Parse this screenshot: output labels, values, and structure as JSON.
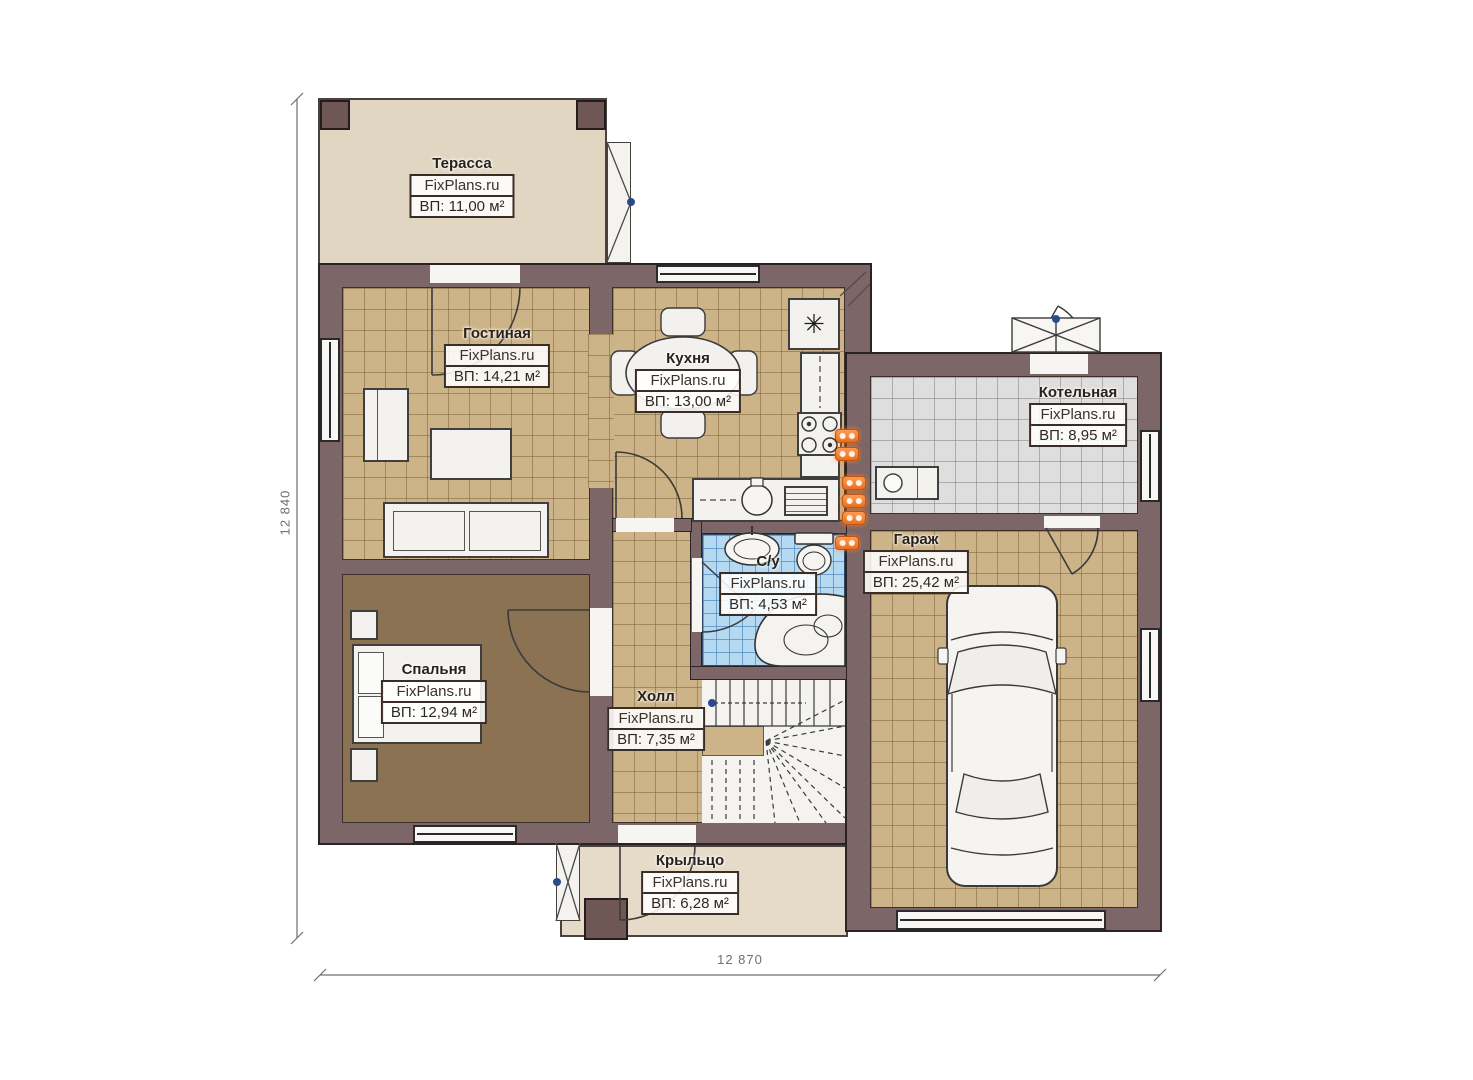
{
  "watermark": "FixPlans.ru",
  "rooms": {
    "terrace": {
      "name": "Терасса",
      "area": "ВП: 11,00 м²"
    },
    "living": {
      "name": "Гостиная",
      "area": "ВП: 14,21 м²"
    },
    "kitchen": {
      "name": "Кухня",
      "area": "ВП: 13,00 м²"
    },
    "boiler": {
      "name": "Котельная",
      "area": "ВП: 8,95 м²"
    },
    "garage": {
      "name": "Гараж",
      "area": "ВП: 25,42 м²"
    },
    "bathroom": {
      "name": "С/у",
      "area": "ВП: 4,53 м²"
    },
    "bedroom": {
      "name": "Спальня",
      "area": "ВП: 12,94 м²"
    },
    "hall": {
      "name": "Холл",
      "area": "ВП: 7,35 м²"
    },
    "porch": {
      "name": "Крыльцо",
      "area": "ВП: 6,28 м²"
    }
  },
  "dimensions": {
    "left": "12 840",
    "bottom": "12 870"
  },
  "symbols": {
    "freezer": "✳"
  },
  "colors": {
    "wall": "#7d6667",
    "floor_tan": "#cdb388",
    "floor_brown": "#8a7253",
    "floor_gray": "#dedede",
    "bath_blue": "#b6d9f2",
    "terrace_beige": "#e1d6c1",
    "radiator_orange": "#f07b28"
  }
}
